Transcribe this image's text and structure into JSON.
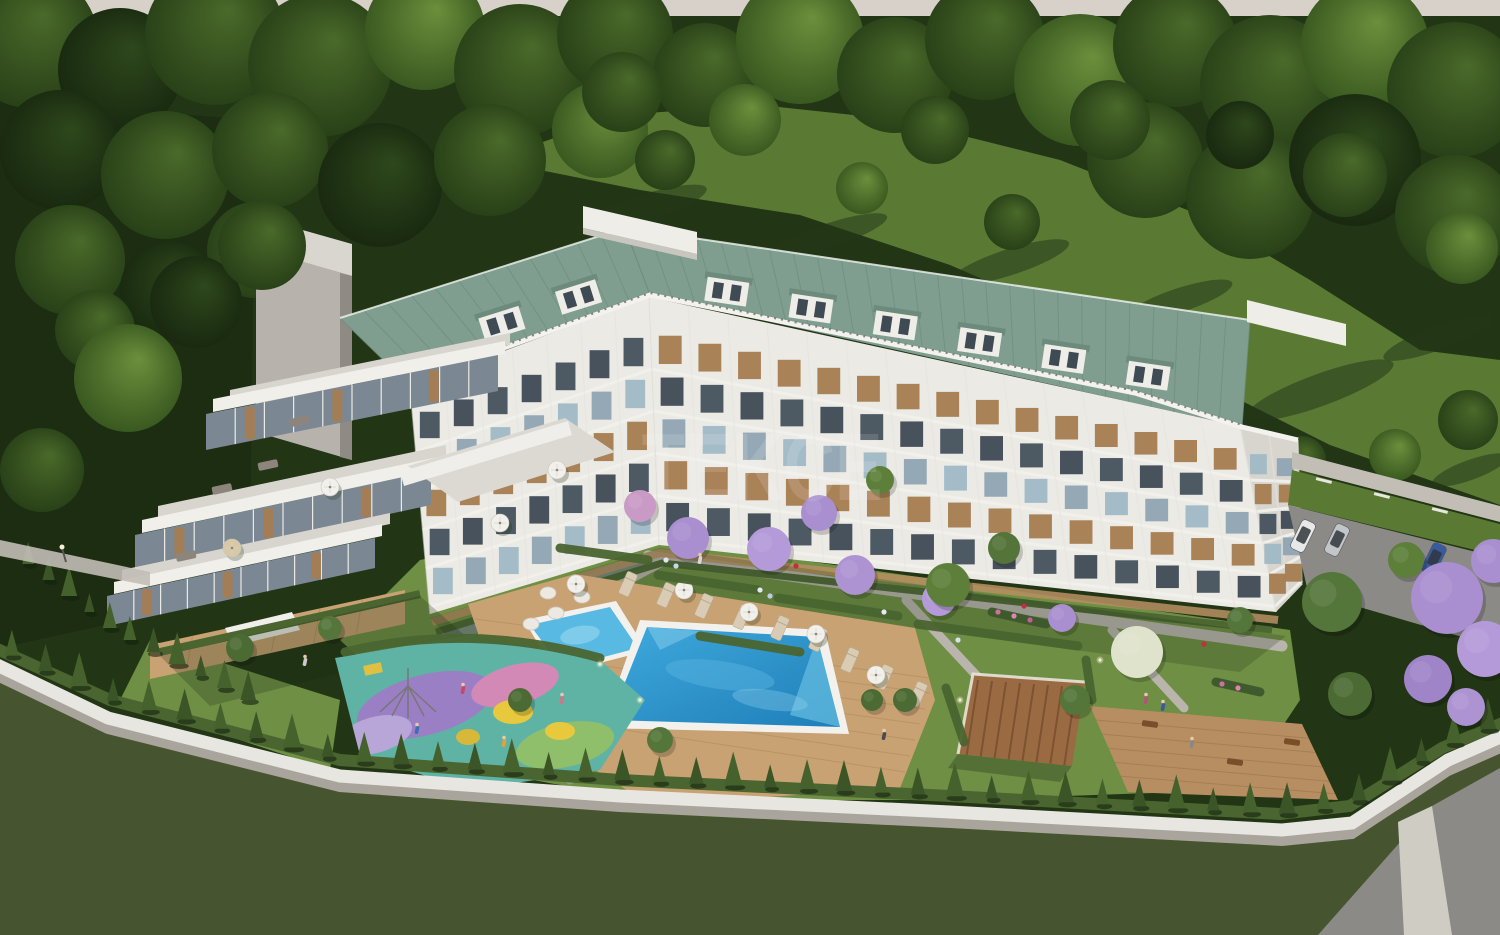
{
  "scene": {
    "description": "Aerial 3D architectural rendering of a residential apartment complex: angled white block with green metal roof, stepped terrace wing, landscaped courtyard with swimming pool, kids pool, colorful playground, pergola, conifer-lined perimeter wall, forest behind and access road with parking.",
    "watermark": {
      "text": "TEKCE",
      "color": "#ffffff",
      "opacity": 0.13
    }
  },
  "palette": {
    "sky": "#d8d1ca",
    "forest_base": "#223515",
    "dark_lawn": "#1d2d11",
    "clearing_lawn": "#5a7a34",
    "courtyard_lawn": "#6f8f45",
    "field_grass": "#46552f",
    "hedge": "#4a6530",
    "conifer": "#3c5527",
    "roof_green": "#7f9e8f",
    "roof_seam": "#6e8d7e",
    "facade_white": "#eceae5",
    "facade_shadow": "#d8d5cf",
    "concrete_core": "#b7b3ac",
    "wood": "#a67c4f",
    "deck_wood": "#c9a273",
    "glass_dark": "#46525c",
    "pool_water_light": "#3fa9dd",
    "pool_water_deep": "#1f7fb8",
    "pool_coping": "#f2f1ed",
    "path_light": "#c2beb6",
    "road_asphalt": "#8b8a86",
    "wall_white": "#e8e6e0",
    "wall_gray": "#a9a59d",
    "playground_teal": "#5fb3a5",
    "playground_purple": "#9b7fc4",
    "playground_pink": "#d389b6",
    "playground_green": "#8fbf6a",
    "playground_yellow": "#e8c93e",
    "jacaranda": "#a98fd0"
  },
  "forest": {
    "trees": [
      [
        30,
        40,
        68,
        1
      ],
      [
        120,
        70,
        62,
        0
      ],
      [
        215,
        35,
        70,
        1
      ],
      [
        320,
        65,
        72,
        1
      ],
      [
        425,
        30,
        60,
        2
      ],
      [
        520,
        70,
        66,
        1
      ],
      [
        615,
        35,
        58,
        1
      ],
      [
        705,
        75,
        52,
        1
      ],
      [
        800,
        40,
        64,
        2
      ],
      [
        895,
        75,
        58,
        1
      ],
      [
        985,
        40,
        60,
        1
      ],
      [
        1080,
        80,
        66,
        2
      ],
      [
        1175,
        45,
        62,
        1
      ],
      [
        1270,
        85,
        70,
        1
      ],
      [
        1365,
        45,
        64,
        2
      ],
      [
        1455,
        90,
        68,
        1
      ],
      [
        60,
        150,
        60,
        0
      ],
      [
        165,
        175,
        64,
        1
      ],
      [
        270,
        150,
        58,
        1
      ],
      [
        380,
        185,
        62,
        0
      ],
      [
        490,
        160,
        56,
        1
      ],
      [
        600,
        130,
        48,
        2
      ],
      [
        1145,
        160,
        58,
        1
      ],
      [
        1250,
        195,
        64,
        1
      ],
      [
        1355,
        160,
        66,
        0
      ],
      [
        1455,
        215,
        60,
        1
      ],
      [
        70,
        260,
        55,
        1
      ],
      [
        170,
        290,
        50,
        0
      ],
      [
        255,
        250,
        48,
        1
      ],
      [
        95,
        330,
        40,
        1
      ],
      [
        665,
        160,
        30,
        1
      ],
      [
        622,
        92,
        40,
        1
      ],
      [
        745,
        120,
        36,
        2
      ],
      [
        862,
        188,
        26,
        2
      ],
      [
        935,
        130,
        34,
        1
      ],
      [
        1012,
        222,
        28,
        1
      ],
      [
        1110,
        120,
        40,
        1
      ],
      [
        1240,
        135,
        34,
        0
      ],
      [
        1345,
        175,
        42,
        1
      ],
      [
        1462,
        248,
        36,
        2
      ],
      [
        1395,
        455,
        26,
        2
      ],
      [
        1468,
        420,
        30,
        1
      ],
      [
        1302,
        460,
        24,
        1
      ]
    ],
    "over_trees": [
      [
        196,
        302,
        46,
        0
      ],
      [
        262,
        246,
        44,
        1
      ],
      [
        128,
        378,
        54,
        2
      ],
      [
        42,
        470,
        42,
        1
      ]
    ]
  },
  "shadows": [
    [
      640,
      210,
      70,
      14,
      -18
    ],
    [
      830,
      235,
      60,
      12,
      -18
    ],
    [
      1010,
      262,
      62,
      13,
      -18
    ],
    [
      1180,
      300,
      55,
      12,
      -18
    ],
    [
      1320,
      390,
      78,
      16,
      -20
    ],
    [
      1438,
      338,
      58,
      12,
      -20
    ],
    [
      1470,
      470,
      40,
      10,
      -20
    ]
  ],
  "building": {
    "floors": 5,
    "window_colors": [
      "#46525c",
      "#a67c4f",
      "#9fb9c6",
      "#3f4a54",
      "#a67c4f",
      "#8fa5b2"
    ],
    "facade_segments": [
      {
        "top": [
          [
            410,
            386
          ],
          [
            649,
            297
          ]
        ],
        "bot": [
          [
            430,
            614
          ],
          [
            659,
            545
          ]
        ],
        "cols": 7
      },
      {
        "top": [
          [
            649,
            297
          ],
          [
            1240,
            426
          ]
        ],
        "bot": [
          [
            659,
            545
          ],
          [
            1276,
            612
          ]
        ],
        "cols": 15
      },
      {
        "top": [
          [
            1240,
            426
          ],
          [
            1298,
            440
          ]
        ],
        "bot": [
          [
            1276,
            612
          ],
          [
            1302,
            585
          ]
        ],
        "cols": 2
      }
    ],
    "roof_segments": [
      {
        "top": [
          [
            340,
            318
          ],
          [
            625,
            228
          ]
        ],
        "bot": [
          [
            407,
            383
          ],
          [
            650,
            295
          ]
        ],
        "seams": 12,
        "dormers": [
          0.45,
          0.75
        ],
        "slope": -17.5
      },
      {
        "top": [
          [
            625,
            228
          ],
          [
            1250,
            320
          ]
        ],
        "bot": [
          [
            650,
            295
          ],
          [
            1242,
            427
          ]
        ],
        "seams": 26,
        "dormers": [
          0.14,
          0.28,
          0.42,
          0.56,
          0.7,
          0.84
        ],
        "slope": 8.4
      }
    ]
  },
  "left_wing": {
    "stripes": [
      {
        "a": [
          230,
          390
        ],
        "b": [
          510,
          333
        ],
        "w": 12,
        "t": "floor"
      },
      {
        "a": [
          213,
          399
        ],
        "b": [
          505,
          341
        ],
        "w": 13,
        "t": "fascia"
      },
      {
        "a": [
          206,
          414
        ],
        "b": [
          498,
          355
        ],
        "w": 36,
        "t": "glass"
      },
      {
        "a": [
          158,
          506
        ],
        "b": [
          446,
          445
        ],
        "w": 12,
        "t": "floor"
      },
      {
        "a": [
          142,
          520
        ],
        "b": [
          438,
          457
        ],
        "w": 13,
        "t": "fascia"
      },
      {
        "a": [
          135,
          535
        ],
        "b": [
          431,
          471
        ],
        "w": 34,
        "t": "glass"
      },
      {
        "a": [
          122,
          570
        ],
        "b": [
          390,
          513
        ],
        "w": 11,
        "t": "floor"
      },
      {
        "a": [
          114,
          582
        ],
        "b": [
          382,
          524
        ],
        "w": 12,
        "t": "fascia"
      },
      {
        "a": [
          107,
          596
        ],
        "b": [
          375,
          538
        ],
        "w": 30,
        "t": "glass"
      },
      {
        "a": [
          150,
          645
        ],
        "b": [
          405,
          590
        ],
        "w": 34,
        "t": "deck"
      }
    ],
    "furniture": [
      [
        300,
        421
      ],
      [
        222,
        489
      ],
      [
        186,
        556
      ],
      [
        268,
        465
      ]
    ]
  },
  "perimeter": {
    "conifer_line": [
      [
        -5,
        648
      ],
      [
        110,
        700
      ],
      [
        340,
        760
      ],
      [
        620,
        780
      ],
      [
        950,
        796
      ],
      [
        1280,
        814
      ],
      [
        1350,
        806
      ],
      [
        1442,
        748
      ],
      [
        1505,
        722
      ]
    ],
    "count": 42,
    "inner_line": [
      [
        118,
        634
      ],
      [
        260,
        706
      ]
    ],
    "inner_count": 6,
    "inner2_line": [
      [
        18,
        556
      ],
      [
        120,
        636
      ]
    ],
    "inner2_count": 5
  },
  "pool": {
    "loungers": [
      [
        628,
        584
      ],
      [
        666,
        595
      ],
      [
        704,
        606
      ],
      [
        742,
        617
      ],
      [
        780,
        628
      ],
      [
        818,
        639
      ],
      [
        850,
        660
      ],
      [
        884,
        677
      ],
      [
        918,
        694
      ]
    ],
    "pods": [
      [
        548,
        593
      ],
      [
        582,
        597
      ],
      [
        556,
        613
      ],
      [
        531,
        624
      ]
    ],
    "umbrellas": [
      [
        576,
        584
      ],
      [
        684,
        590
      ],
      [
        749,
        612
      ],
      [
        816,
        634
      ],
      [
        583,
        672
      ],
      [
        876,
        675
      ]
    ]
  },
  "terrace_umbrellas": [
    [
      232,
      548,
      "#d8c8a6"
    ],
    [
      330,
      487,
      "#f2f0ea"
    ],
    [
      557,
      470,
      "#f2f0ea"
    ],
    [
      500,
      523,
      "#f2f0ea"
    ]
  ],
  "garden_trees": [
    [
      640,
      506,
      16,
      "#c99ac6"
    ],
    [
      688,
      538,
      21,
      "#a98fd0"
    ],
    [
      769,
      549,
      22,
      "#b49ad8"
    ],
    [
      819,
      513,
      18,
      "#a98fd0"
    ],
    [
      855,
      575,
      20,
      "#ad93d2"
    ],
    [
      939,
      599,
      17,
      "#b49ad8"
    ],
    [
      1062,
      618,
      14,
      "#a98fd0"
    ],
    [
      948,
      585,
      22,
      "#5d7f3a"
    ],
    [
      1004,
      548,
      16,
      "#54743a"
    ],
    [
      880,
      480,
      14,
      "#5d7f3a"
    ],
    [
      1137,
      652,
      26,
      "#dfe3cb"
    ],
    [
      1332,
      602,
      30,
      "#55763b"
    ],
    [
      1350,
      694,
      22,
      "#4c6b34"
    ],
    [
      1406,
      560,
      18,
      "#5d7f3a"
    ],
    [
      1447,
      598,
      36,
      "#a98fd0"
    ],
    [
      1485,
      649,
      28,
      "#b49ad8"
    ],
    [
      1428,
      679,
      24,
      "#9f84c8"
    ],
    [
      1493,
      561,
      22,
      "#a98fd0"
    ],
    [
      1466,
      707,
      19,
      "#ad93d2"
    ],
    [
      240,
      648,
      14,
      "#4c6b34"
    ],
    [
      330,
      628,
      12,
      "#55763b"
    ],
    [
      520,
      700,
      12,
      "#4c6b34"
    ],
    [
      660,
      740,
      13,
      "#55763b"
    ],
    [
      905,
      700,
      12,
      "#4c6b34"
    ],
    [
      1240,
      620,
      13,
      "#55763b"
    ],
    [
      1075,
      700,
      15,
      "#55763b"
    ],
    [
      872,
      700,
      11,
      "#4c6b34"
    ]
  ],
  "cars": [
    [
      1303,
      536,
      "#e8e8e8"
    ],
    [
      1337,
      540,
      "#c3c6c9"
    ],
    [
      1434,
      559,
      "#3a5a9e"
    ]
  ],
  "figures": [
    [
      463,
      690,
      "#cc4466"
    ],
    [
      417,
      730,
      "#3a6fb3"
    ],
    [
      504,
      743,
      "#e0a23c"
    ],
    [
      562,
      700,
      "#cc7788"
    ],
    [
      305,
      662,
      "#cccccc"
    ],
    [
      884,
      736,
      "#4a4a55"
    ],
    [
      1146,
      700,
      "#b05577"
    ],
    [
      1163,
      707,
      "#3a5aa0"
    ],
    [
      1192,
      744,
      "#888888"
    ],
    [
      700,
      560,
      "#d8d8d8"
    ]
  ],
  "flower_dots": [
    [
      998,
      612,
      "#d06fa0"
    ],
    [
      1014,
      616,
      "#e083b5"
    ],
    [
      1030,
      620,
      "#c55f95"
    ],
    [
      666,
      560,
      "#dfe6f0"
    ],
    [
      676,
      566,
      "#c9d6ea"
    ],
    [
      760,
      590,
      "#e4e9f2"
    ],
    [
      770,
      596,
      "#bcccE4"
    ],
    [
      884,
      612,
      "#e4e9f2"
    ],
    [
      958,
      640,
      "#d8e0ee"
    ],
    [
      1222,
      684,
      "#d06fa0"
    ],
    [
      1238,
      688,
      "#e083b5"
    ],
    [
      796,
      566,
      "#c03040"
    ],
    [
      1024,
      606,
      "#c03040"
    ],
    [
      1204,
      644,
      "#c03040"
    ]
  ],
  "bollards": [
    [
      600,
      664
    ],
    [
      640,
      700
    ],
    [
      960,
      700
    ],
    [
      1100,
      660
    ]
  ]
}
